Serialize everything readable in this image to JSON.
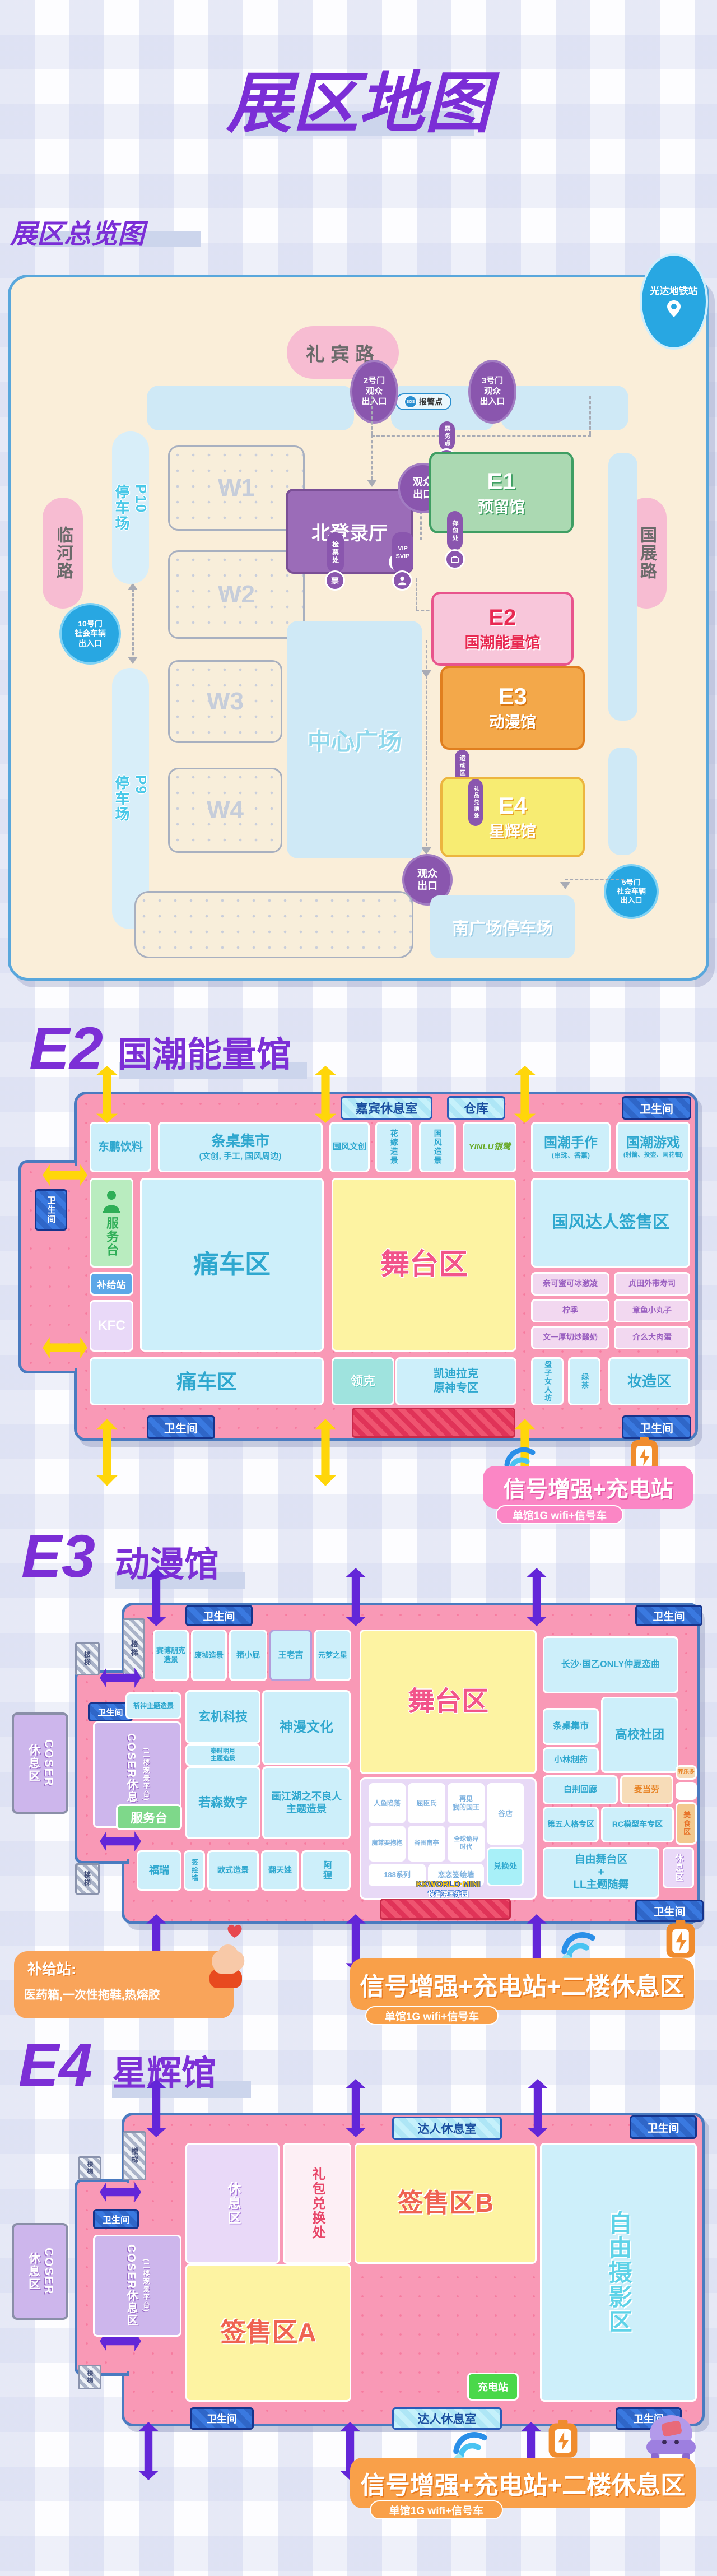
{
  "header": {
    "title": "展区地图",
    "overview_title": "展区总览图"
  },
  "common": {
    "toilet": "卫生间",
    "stairs": "楼梯"
  },
  "overview": {
    "station": "光达地铁站",
    "roads": {
      "north": "礼宾路",
      "west": "临河路",
      "east": "国展路"
    },
    "gates": {
      "g2": "2号门\n观众\n出入口",
      "g3": "3号门\n观众\n出入口",
      "g10": "10号门\n社会车辆\n出入口",
      "g5": "5号门\n社会车辆\n出入口"
    },
    "points": {
      "alarm": "报警点",
      "sos": "SOS",
      "ticket_point": "票务点",
      "info": "i",
      "exit": "观众\n出口",
      "checkpoint": "检票处",
      "ticket": "票",
      "vip": "VIP\nSVIP",
      "bag": "存包处",
      "sport": "运动区",
      "gift": "礼品兑换处"
    },
    "areas": {
      "north_hall": "北登录厅",
      "center": "中心广场",
      "south_parking": "南广场停车场",
      "w1": "W1",
      "w2": "W2",
      "w3": "W3",
      "w4": "W4",
      "p10": "P10\n停车场",
      "p9": "P9\n停车场",
      "e1_code": "E1",
      "e1_name": "预留馆",
      "e2_code": "E2",
      "e2_name": "国潮能量馆",
      "e3_code": "E3",
      "e3_name": "动漫馆",
      "e4_code": "E4",
      "e4_name": "星辉馆"
    }
  },
  "e2": {
    "code": "E2",
    "name": "国潮能量馆",
    "rooms": {
      "guest": "嘉宾休息室",
      "store": "仓库",
      "dongpeng": "东鹏饮料",
      "market": "条桌集市",
      "market_sub": "(文创, 手工, 国风周边)",
      "wenchuang": "国风文创",
      "huajia": "花嫁造景",
      "zaojing": "国风造景",
      "yinlu": "YINLU银鹭",
      "shouzuo": "国潮手作",
      "shouzuo_sub": "(串珠、香薰)",
      "youxi": "国潮游戏",
      "youxi_sub": "(射箭、投壶、画花钿)",
      "service": "服务台",
      "tongche": "痛车区",
      "stage": "舞台区",
      "signing": "国风达人签售区",
      "food1": "亲可蜜可冰激凌",
      "food2": "贞田外带寿司",
      "food3": "柠季",
      "food4": "章鱼小丸子",
      "food5": "文一厚切炒酸奶",
      "food6": "介么大肉蛋",
      "supply": "补给站",
      "kfc": "KFC",
      "tongche2": "痛车区",
      "lynk": "领克",
      "cadillac": "凯迪拉克\n原神专区",
      "panzi": "盘子女人坊",
      "lvcha": "绿茶",
      "makeup": "妆造区"
    },
    "badge": {
      "main": "信号增强+充电站",
      "sub": "单馆1G wifi+信号车"
    }
  },
  "e3": {
    "code": "E3",
    "name": "动漫馆",
    "rooms": {
      "cyberpunk": "赛博朋克\n造景",
      "ruins": "废墟造景",
      "zhu": "猪小屁",
      "wlj": "王老吉",
      "yuanmeng": "元梦之星",
      "stage": "舞台区",
      "changsha": "长沙·国乙ONLY仲夏恋曲",
      "zhanshen": "斩神主题造景",
      "xuanji": "玄机科技",
      "shenman": "神漫文化",
      "qinshi": "秦时明月\n主题造景",
      "coser_outer": "COSER\n休息区",
      "coser_inner": "COSER休息区",
      "coser_inner_sub": "(二楼观景平台)",
      "service": "服务台",
      "ruosen": "若森数字",
      "huajianghu": "画江湖之不良人\n主题造景",
      "furui": "福瑞",
      "qianhui": "签绘墙",
      "oushi": "欧式造景",
      "fantianwa": "翻天娃",
      "ali": "阿狸",
      "renyu": "人鱼陷落",
      "qcs": "屈臣氏",
      "zaijian": "再见\n我的国王",
      "gudian": "谷店",
      "mozun": "魔尊要抱抱",
      "guwei": "谷围南亭",
      "quanqiu": "全球诡异\n时代",
      "duihuan": "兑换处",
      "x188": "188系列",
      "lianlian": "恋恋签绘墙",
      "tiaozhuo": "条桌集市",
      "gaoxiao": "高校社团",
      "xiaolin": "小林制药",
      "baijing": "白荆回廊",
      "mcd": "麦当劳",
      "yakult": "养乐多",
      "meishi": "美食区",
      "diwu": "第五人格专区",
      "rc": "RC模型车专区",
      "freestage": "自由舞台区\n+\nLL主题随舞",
      "rest": "休息区"
    },
    "logo": {
      "line1": "KKWORLD·MINI",
      "line2": "悦看漫画乐园"
    },
    "supply": {
      "title": "补给站:",
      "body": "医药箱,一次性拖鞋,热熔胶"
    },
    "badge": {
      "main": "信号增强+充电站+二楼休息区",
      "sub": "单馆1G wifi+信号车"
    }
  },
  "e4": {
    "code": "E4",
    "name": "星辉馆",
    "rooms": {
      "daren": "达人休息室",
      "coser_outer": "COSER\n休息区",
      "coser_inner": "COSER休息区",
      "coser_inner_sub": "(二楼观景平台)",
      "rest": "休息区",
      "libao": "礼包兑换处",
      "qs_b": "签售区B",
      "photo": "自由摄影区",
      "qs_a": "签售区A",
      "charge": "充电站"
    },
    "badge": {
      "main": "信号增强+充电站+二楼休息区",
      "sub": "单馆1G wifi+信号车"
    }
  }
}
